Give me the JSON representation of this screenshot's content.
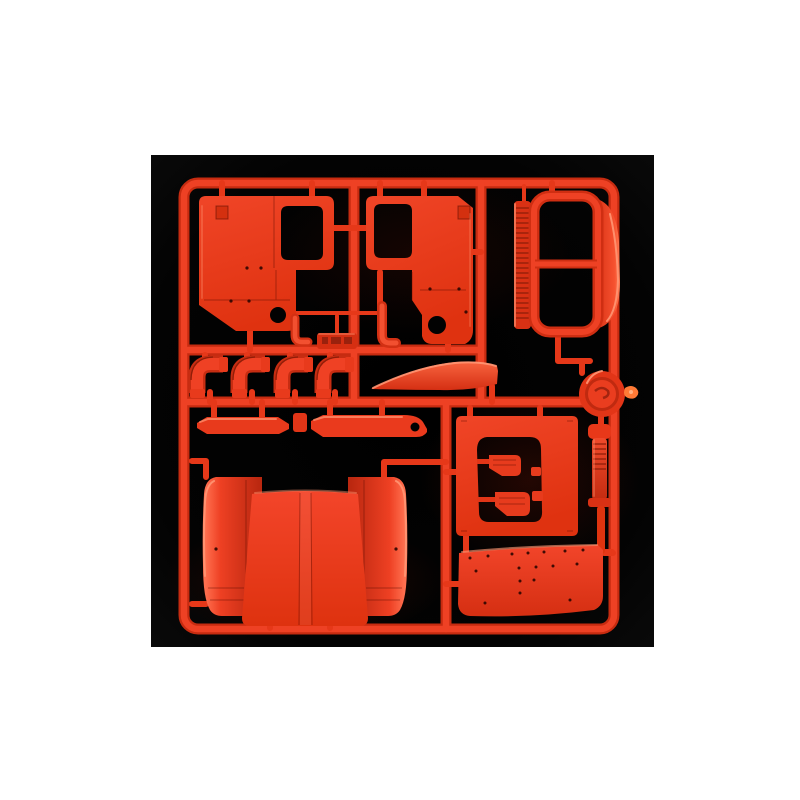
{
  "scene": {
    "type": "product-photo",
    "subject": "Bright red plastic model-kit sprue (parts tree) with truck cab parts, photographed on a black background centered on a white page",
    "photo_background": "black square",
    "page_background": "white"
  },
  "colors": {
    "page_background": "#ffffff",
    "photo_background": "#020202",
    "plastic_red": "#e83a1c",
    "plastic_red_bright": "#f25030",
    "plastic_red_deep": "#c62b10",
    "plastic_shadow": "#9c2008",
    "edge_highlight": "#ff8a64",
    "gate_nub_orange": "#ff7a36"
  },
  "parts": [
    {
      "id": "sprue-frame",
      "name": "Sprue runner frame",
      "description": "Square red runner frame with internal runners and feed gates"
    },
    {
      "id": "cab-side-panel-left",
      "name": "Cab side panel (left)",
      "description": "Truck cab left side panel with door window opening, vent, and round mirror-mount hole"
    },
    {
      "id": "cab-side-panel-right",
      "name": "Cab side panel (right)",
      "description": "Mirrored truck cab right side panel with door window opening, vent, and round hole"
    },
    {
      "id": "windshield-assembly",
      "name": "Windshield frame assembly",
      "description": "Two-pane windshield surround with ribbed grille strip and curved roof edge panel"
    },
    {
      "id": "intake-elbows",
      "name": "Intake elbow pipes",
      "count": 4,
      "description": "Four ribbed 90-degree elbow pipe fittings in a row"
    },
    {
      "id": "hinge-brackets",
      "name": "Hinge brackets",
      "count": 2,
      "description": "Two small bent hinge/latch brackets between the cab panels"
    },
    {
      "id": "molded-id-tab",
      "name": "Molded ID tab",
      "description": "Raised runner tab with illegible embossed part-code lettering"
    },
    {
      "id": "step-bars",
      "name": "Step bars",
      "count": 2,
      "description": "Two long side-step/bumper bars, right bar with round hole, plus a small link piece"
    },
    {
      "id": "sun-visor",
      "name": "Sun visor blade",
      "description": "Curved sun visor / wind deflector blade"
    },
    {
      "id": "round-cap",
      "name": "Round cap disc",
      "description": "Round cap/horn disc with swirl detail and bright orange gate nub at the sprue edge"
    },
    {
      "id": "exhaust-rod",
      "name": "Exhaust stack rod",
      "description": "Ribbed vertical exhaust stack rod with collar"
    },
    {
      "id": "cutout-panel",
      "name": "Panel with door cutout",
      "description": "Rear cab panel with door-shaped cutout holding two step brackets and two small clips"
    },
    {
      "id": "mudguard-panel",
      "name": "Riveted mudguard panel",
      "description": "Wide lower mudguard panel dotted with rivets"
    },
    {
      "id": "cab-back-assembly",
      "name": "Cab back and fenders",
      "description": "Large cab back/roof panel with central spine flanked by two curved fenders"
    }
  ]
}
